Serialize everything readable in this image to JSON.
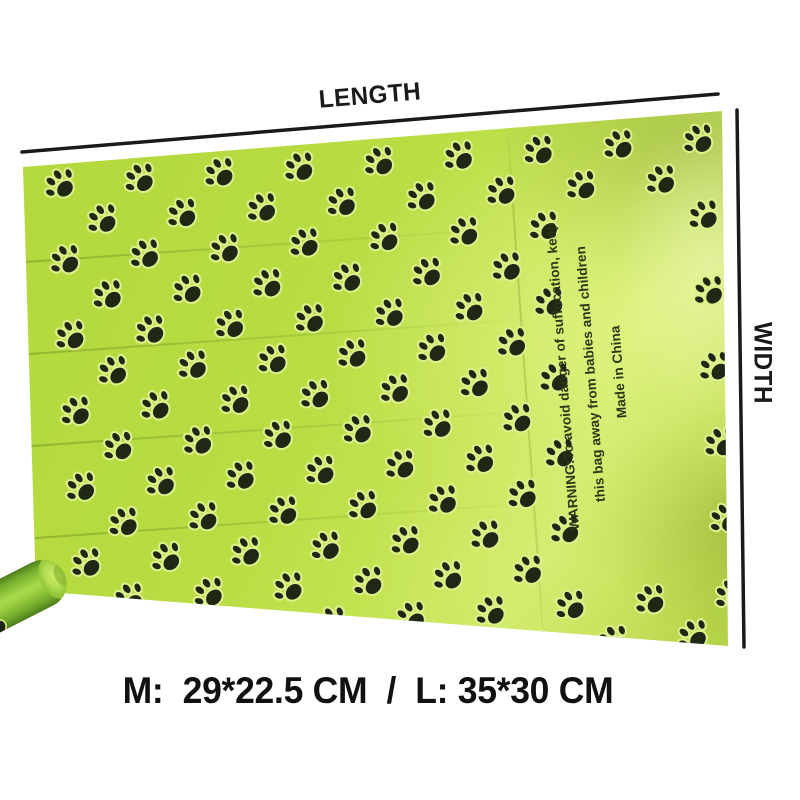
{
  "dimension_labels": {
    "length": "LENGTH",
    "width": "WIDTH"
  },
  "size_caption": "M:  29*22.5 CM  /  L: 35*30 CM",
  "bag": {
    "warning_lines": [
      "WARNING:To avoid danger of suffocation, keep",
      "this bag away from babies and children",
      "Made in China"
    ],
    "pattern": {
      "cols": 10,
      "rows": 14,
      "dx": 80,
      "dy": 38,
      "row_offset": 40,
      "start_x": 30,
      "start_y": 2,
      "paw_size": 42,
      "paw_rotation_deg": -42
    },
    "colors": {
      "base_green": "#b8dc42",
      "light_green": "#cdea66",
      "dark_green": "#9abb3a",
      "paw_black": "#1e2815",
      "paw_halo": "#dcf08c",
      "warning_text": "#2a3616"
    }
  },
  "roll": {
    "colors": {
      "body_light": "#a9da4c",
      "body_dark": "#4f7d1c",
      "cap_green": "#b3dd50"
    }
  },
  "annotation": {
    "line_color": "#1a1a1a",
    "text_color": "#1a1a1a"
  }
}
